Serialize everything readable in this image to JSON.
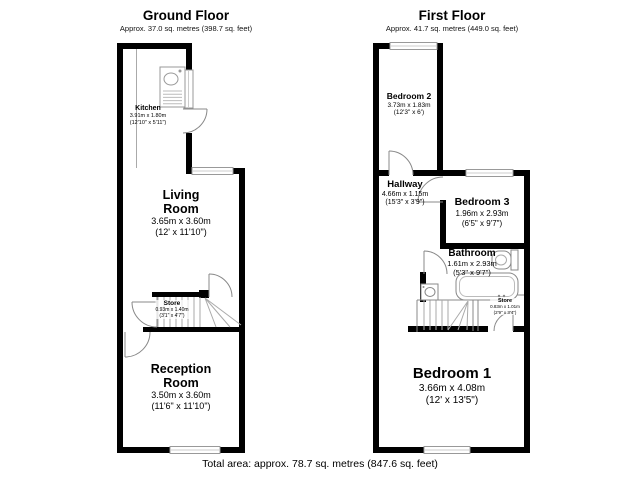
{
  "ground_floor": {
    "title": "Ground Floor",
    "subtitle": "Approx. 37.0 sq. metres (398.7 sq. feet)",
    "rooms": {
      "kitchen": {
        "name": "Kitchen",
        "metric": "3.91m x 1.80m",
        "imperial": "(12'10\" x 5'11\")"
      },
      "living_room": {
        "name": "Living Room",
        "metric": "3.65m x 3.60m",
        "imperial": "(12' x 11'10\")"
      },
      "store": {
        "name": "Store",
        "metric": "0.93m x 1.40m",
        "imperial": "(3'1\" x 4'7\")"
      },
      "reception_room": {
        "name": "Reception Room",
        "metric": "3.50m x 3.60m",
        "imperial": "(11'6\" x 11'10\")"
      }
    }
  },
  "first_floor": {
    "title": "First Floor",
    "subtitle": "Approx. 41.7 sq. metres (449.0 sq. feet)",
    "rooms": {
      "bedroom_2": {
        "name": "Bedroom 2",
        "metric": "3.73m x 1.83m",
        "imperial": "(12'3\" x 6')"
      },
      "hallway": {
        "name": "Hallway",
        "metric": "4.66m x 1.15m",
        "imperial": "(15'3\" x 3'9\")"
      },
      "bedroom_3": {
        "name": "Bedroom 3",
        "metric": "1.96m x 2.93m",
        "imperial": "(6'5\" x 9'7\")"
      },
      "bathroom": {
        "name": "Bathroom",
        "metric": "1.61m x 2.93m",
        "imperial": "(5'3\" x 9'7\")"
      },
      "store": {
        "name": "Store",
        "metric": "0.83m x 1.01m",
        "imperial": "(2'9\" x 3'4\")"
      },
      "bedroom_1": {
        "name": "Bedroom 1",
        "metric": "3.66m x 4.08m",
        "imperial": "(12' x 13'5\")"
      }
    }
  },
  "footer": {
    "total_area": "Total area: approx. 78.7 sq. metres (847.6 sq. feet)"
  },
  "colors": {
    "wall": "#000000",
    "fixture_line": "#999999",
    "background": "#ffffff"
  }
}
